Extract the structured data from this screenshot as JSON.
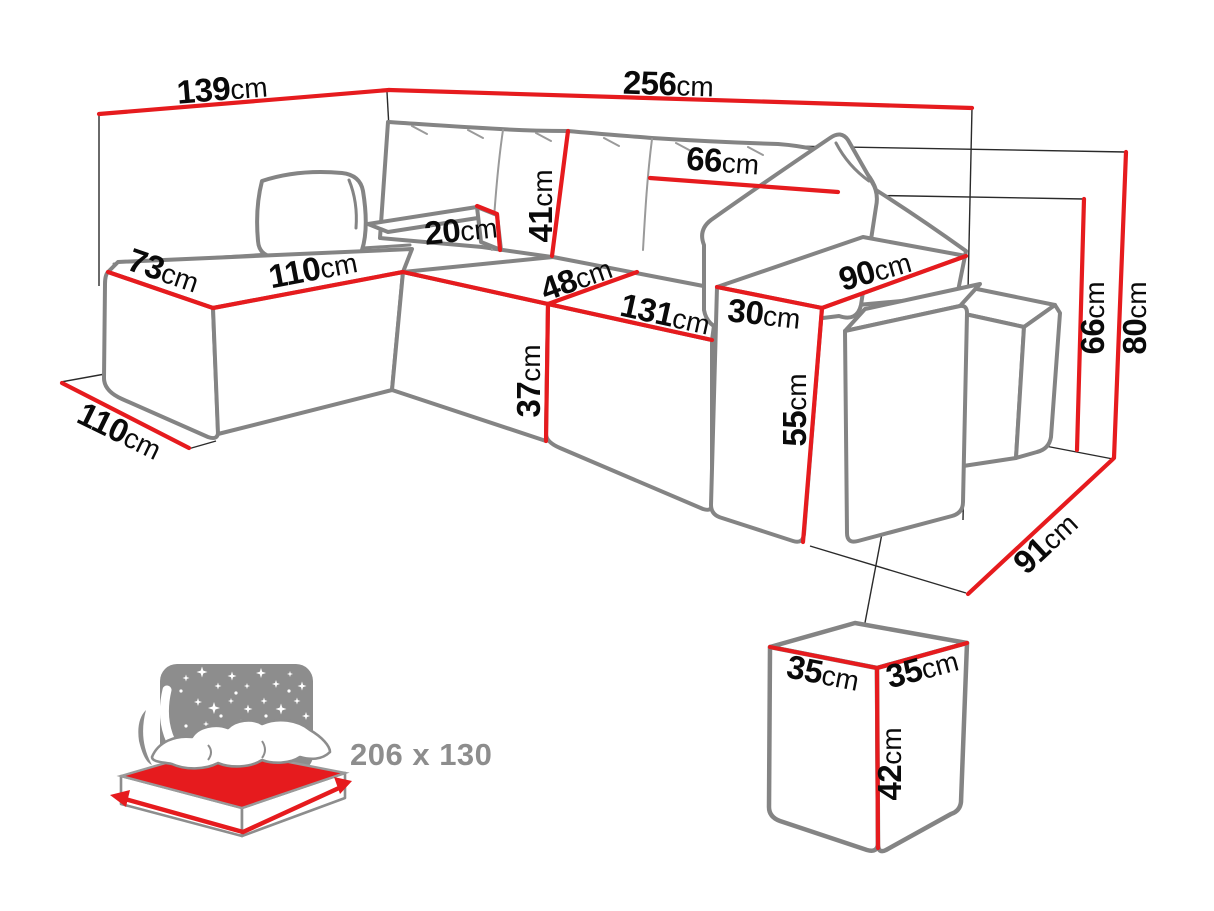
{
  "page": {
    "type": "furniture-dimension-diagram",
    "product": "corner-sofa-bed-with-poufs",
    "background": "#ffffff"
  },
  "colors": {
    "dimension_red": "#e61b1e",
    "sofa_outline_gray": "#848484",
    "projection_line": "#2a2a2a",
    "label_text": "#0a0a0a",
    "icon_gray": "#8d8d8d"
  },
  "dimensions": [
    {
      "part": "back-width-left",
      "value": "139",
      "unit": "cm"
    },
    {
      "part": "back-width-right",
      "value": "256",
      "unit": "cm"
    },
    {
      "part": "side-rail-height",
      "value": "20",
      "unit": "cm"
    },
    {
      "part": "chaise-width",
      "value": "73",
      "unit": "cm"
    },
    {
      "part": "chaise-seat-length",
      "value": "110",
      "unit": "cm"
    },
    {
      "part": "back-cushion-height",
      "value": "41",
      "unit": "cm"
    },
    {
      "part": "back-pillow-width",
      "value": "66",
      "unit": "cm"
    },
    {
      "part": "seat-depth",
      "value": "48",
      "unit": "cm"
    },
    {
      "part": "seat-front-length",
      "value": "131",
      "unit": "cm"
    },
    {
      "part": "armrest-width",
      "value": "30",
      "unit": "cm"
    },
    {
      "part": "armrest-depth",
      "value": "90",
      "unit": "cm"
    },
    {
      "part": "seat-height",
      "value": "37",
      "unit": "cm"
    },
    {
      "part": "armrest-height",
      "value": "55",
      "unit": "cm"
    },
    {
      "part": "backrest-height",
      "value": "66",
      "unit": "cm"
    },
    {
      "part": "total-height",
      "value": "80",
      "unit": "cm"
    },
    {
      "part": "side-depth",
      "value": "91",
      "unit": "cm"
    },
    {
      "part": "chaise-floor-depth",
      "value": "110",
      "unit": "cm"
    },
    {
      "part": "pouf-width",
      "value": "35",
      "unit": "cm"
    },
    {
      "part": "pouf-depth",
      "value": "35",
      "unit": "cm"
    },
    {
      "part": "pouf-height",
      "value": "42",
      "unit": "cm"
    }
  ],
  "sleeping_icon": {
    "name": "sleeping-function-icon",
    "bed_size_label": "206 x 130"
  }
}
